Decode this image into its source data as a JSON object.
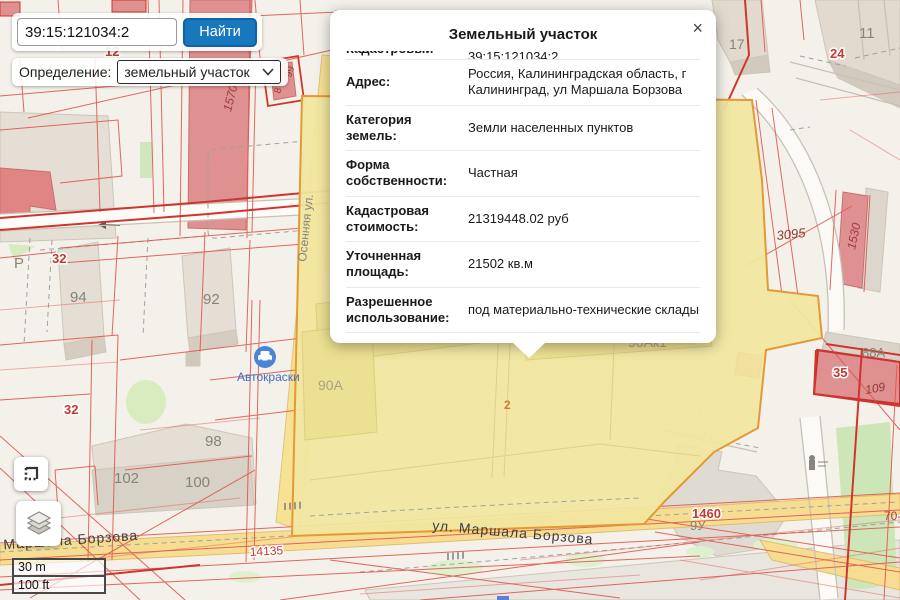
{
  "search": {
    "value": "39:15:121034:2",
    "button_label": "Найти"
  },
  "definition": {
    "label": "Определение:",
    "selected": "земельный участок"
  },
  "popup": {
    "title": "Земельный участок",
    "close_label": "×",
    "rows": [
      {
        "label": "Кадастровый номер:",
        "value": "39:15:121034:2",
        "partially_visible": true
      },
      {
        "label": "Адрес:",
        "value": "Россия, Калининградская область, г Калининград, ул Маршала Борзова"
      },
      {
        "label": "Категория земель:",
        "value": "Земли населенных пунктов"
      },
      {
        "label": "Форма собственности:",
        "value": "Частная"
      },
      {
        "label": "Кадастровая стоимость:",
        "value": "21319448.02 руб"
      },
      {
        "label": "Уточненная площадь:",
        "value": "21502 кв.м"
      },
      {
        "label": "Разрешенное использование:",
        "value": "под материально-технические склады"
      }
    ]
  },
  "scalebar": {
    "metric": "30 m",
    "imperial": "100 ft"
  },
  "map": {
    "colors": {
      "base": "#f4f1eb",
      "cadastral_line": "#e0564c",
      "cadastral_thick": "#cf352e",
      "parcel_fill": "#f1e6a0",
      "parcel_border": "#e39a35",
      "road_fill": "#f7dd92",
      "building_grey": "#e4ded4",
      "building_red": "#df9090",
      "green": "#d8ecc0",
      "poi_blue": "#4a84d9",
      "button_blue": "#1878be"
    },
    "poi": {
      "name": "Автокраски"
    },
    "labels": [
      {
        "text": "12",
        "x": 105,
        "y": 56,
        "c": "#bf3a32",
        "s": 13,
        "b": 1,
        "halo": 1
      },
      {
        "text": "8",
        "x": 280,
        "y": 94,
        "c": "#a03c3c",
        "s": 10,
        "r": -72
      },
      {
        "text": "99",
        "x": 291,
        "y": 78,
        "c": "#a03c3c",
        "s": 10,
        "r": -72
      },
      {
        "text": "1570",
        "x": 231,
        "y": 112,
        "c": "#a03c3c",
        "s": 12,
        "r": -76,
        "i": 1
      },
      {
        "text": "Осенняя ул.",
        "x": 306,
        "y": 262,
        "c": "#84847c",
        "s": 12,
        "r": -84
      },
      {
        "text": "Р",
        "x": 14,
        "y": 268,
        "c": "#84847c",
        "s": 15
      },
      {
        "text": "32",
        "x": 52,
        "y": 263,
        "c": "#bf3a32",
        "s": 13,
        "b": 1,
        "halo": 1
      },
      {
        "text": "94",
        "x": 70,
        "y": 302,
        "c": "#84847c",
        "s": 15
      },
      {
        "text": "92",
        "x": 203,
        "y": 304,
        "c": "#84847c",
        "s": 15
      },
      {
        "text": "32",
        "x": 64,
        "y": 414,
        "c": "#bf3a32",
        "s": 13,
        "b": 1,
        "halo": 1
      },
      {
        "text": "Автокраски",
        "x": 237,
        "y": 381,
        "c": "#3f6fc0",
        "s": 12
      },
      {
        "text": "98",
        "x": 205,
        "y": 446,
        "c": "#84847c",
        "s": 15
      },
      {
        "text": "102",
        "x": 114,
        "y": 483,
        "c": "#84847c",
        "s": 15
      },
      {
        "text": "100",
        "x": 185,
        "y": 487,
        "c": "#84847c",
        "s": 15
      },
      {
        "text": "Альянс мастер",
        "x": 344,
        "y": 296,
        "c": "#85a8a4",
        "s": 13
      },
      {
        "text": "90А",
        "x": 318,
        "y": 390,
        "c": "#a7a387",
        "s": 14
      },
      {
        "text": "90Ак1",
        "x": 628,
        "y": 347,
        "c": "#a7a387",
        "s": 14
      },
      {
        "text": "2",
        "x": 504,
        "y": 409,
        "c": "#cc7a3d",
        "s": 12,
        "b": 1
      },
      {
        "text": "3095",
        "x": 777,
        "y": 240,
        "c": "#8f3b34",
        "s": 13,
        "r": -6,
        "i": 1
      },
      {
        "text": "1530",
        "x": 855,
        "y": 250,
        "c": "#a03c3c",
        "s": 12,
        "r": -78,
        "i": 1
      },
      {
        "text": "17",
        "x": 729,
        "y": 49,
        "c": "#84847c",
        "s": 14
      },
      {
        "text": "11",
        "x": 859,
        "y": 38,
        "c": "#84847c",
        "s": 15
      },
      {
        "text": "24",
        "x": 830,
        "y": 58,
        "c": "#bf3a32",
        "s": 13,
        "b": 1,
        "halo": 1
      },
      {
        "text": "88А",
        "x": 862,
        "y": 357,
        "c": "#84847c",
        "s": 13
      },
      {
        "text": "35",
        "x": 833,
        "y": 377,
        "c": "#bf3a32",
        "s": 13,
        "b": 1,
        "halo": 1
      },
      {
        "text": "109",
        "x": 866,
        "y": 394,
        "c": "#8f3b34",
        "s": 12,
        "r": -10,
        "i": 1
      },
      {
        "text": "1460",
        "x": 692,
        "y": 518,
        "c": "#bf3a32",
        "s": 13,
        "b": 1,
        "halo": 1
      },
      {
        "text": "9У",
        "x": 690,
        "y": 530,
        "c": "#84847c",
        "s": 13
      },
      {
        "text": "ул. Маршала Борзова",
        "x": 432,
        "y": 530,
        "c": "#3f3f3f",
        "s": 14,
        "r": 5,
        "ls": 1
      },
      {
        "text": ". Маршала Борзова",
        "x": -6,
        "y": 550,
        "c": "#3f3f3f",
        "s": 14,
        "r": -4,
        "ls": 1
      },
      {
        "text": "14135",
        "x": 250,
        "y": 556,
        "c": "#bf3a32",
        "s": 12,
        "r": -3,
        "halo": 1
      },
      {
        "text": "70-",
        "x": 884,
        "y": 520,
        "c": "#bf3a32",
        "s": 12
      }
    ]
  }
}
